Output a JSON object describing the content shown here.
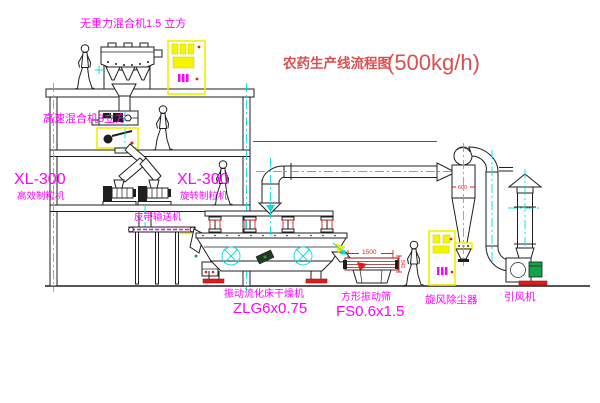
{
  "title": {
    "text": "农药生产线流程图",
    "capacity": "(500kg/h)"
  },
  "equipment_labels": {
    "gravity_mixer": "无重力混合机1.5 立方",
    "high_speed_mixer": "高速混合机3立方",
    "granulator_left_model": "XL-300",
    "granulator_left_name": "高效制粒机",
    "granulator_right_model": "XL-300",
    "granulator_right_name": "旋转制粒机",
    "belt_conveyor": "皮带输送机",
    "fluid_bed_dryer_name": "振动流化床干燥机",
    "fluid_bed_dryer_model": "ZLG6x0.75",
    "vibrating_screen_name": "方形振动筛",
    "vibrating_screen_model": "FS0.6x1.5",
    "cyclone": "旋风除尘器",
    "induced_draft_fan": "引风机"
  },
  "dimensions": {
    "screen_length": "1500",
    "screen_height": "540",
    "cyclone_diameter": "600"
  },
  "colors": {
    "label_magenta": "#FF00FF",
    "title_red": "#D85050",
    "dimension_red": "#E81818",
    "centerline_cyan": "#00DEDE",
    "cabinet_yellow": "#F5F500",
    "motor_green": "#16A24A",
    "screen_maroon": "#8B1A1A",
    "line_black": "#1F1F1F",
    "background": "#FFFFFF"
  }
}
